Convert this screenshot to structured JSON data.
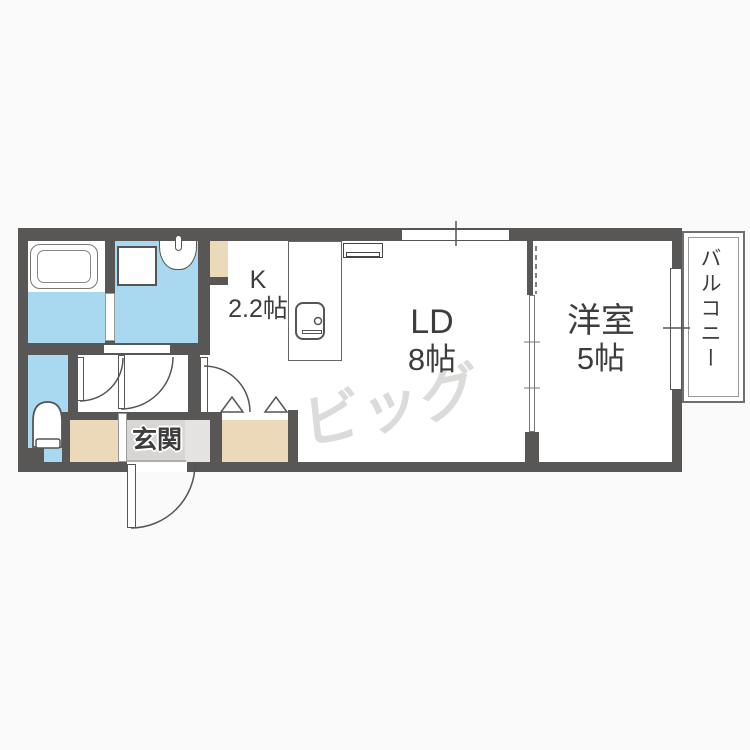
{
  "floorplan": {
    "rooms": {
      "kitchen": {
        "label": "K",
        "size": "2.2帖"
      },
      "living_dining": {
        "label": "LD",
        "size": "8帖"
      },
      "western_room": {
        "label": "洋室",
        "size": "5帖"
      },
      "entrance": {
        "label": "玄関"
      },
      "balcony": {
        "label": "バルコニー"
      }
    },
    "watermark": "ビッグ",
    "fixture_icons": [
      "bathtub-icon",
      "washing-machine-icon",
      "washbasin-icon",
      "toilet-icon",
      "kitchen-counter-icon",
      "stove-icon",
      "air-conditioner-icon",
      "window-icon",
      "door-swing-icon",
      "folding-door-icon",
      "sliding-partition-icon"
    ],
    "colors": {
      "wall": "#595656",
      "water_area": "#a8d9f1",
      "storage_area": "#ecd9ba",
      "entrance_floor": "#d8d6d4",
      "watermark": "#dcdbda",
      "background": "#fbfafa"
    }
  }
}
